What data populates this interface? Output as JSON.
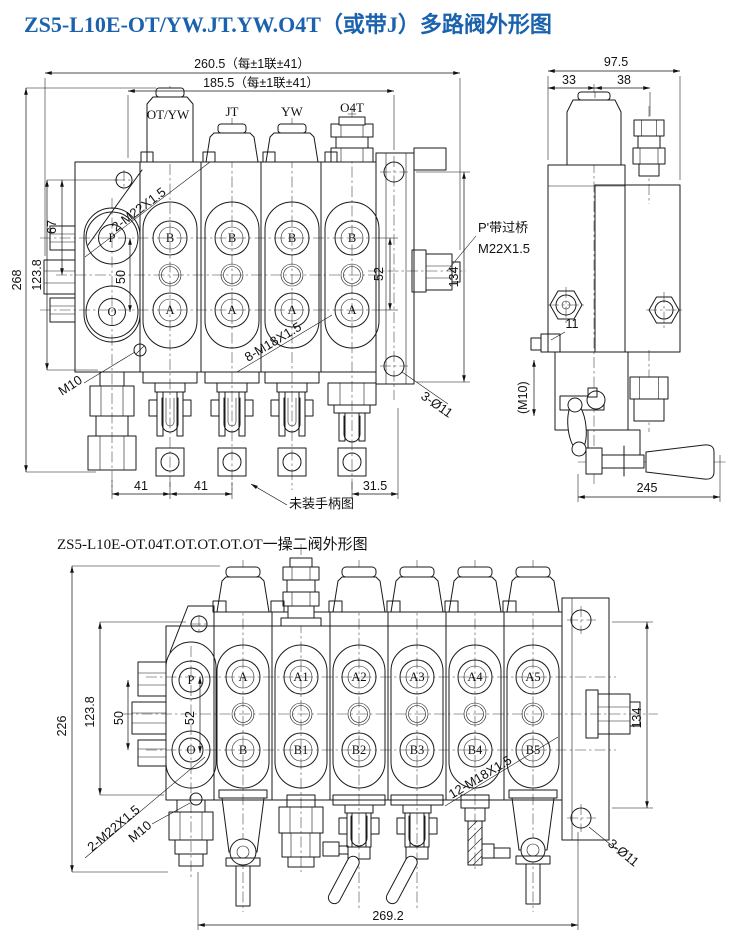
{
  "colors": {
    "background": "#ffffff",
    "line": "#1a1a1a",
    "title": "#1b62ae"
  },
  "fig1": {
    "title": "ZS5-L10E-OT/YW.JT.YW.O4T（或带J）多路阀外形图",
    "front": {
      "dim_total_width": "260.5（每±1联±41）",
      "dim_inner_width": "185.5（每±1联±41）",
      "dim_total_height": "268",
      "dim_mid_height": "123.8",
      "dim_top_height": "67",
      "dim_po_spacing": "50",
      "dim_ab_spacing": "52",
      "dim_plate_height": "134",
      "dim_spool_pitch_1": "41",
      "dim_spool_pitch_2": "41",
      "dim_end_offset": "31.5",
      "section_labels": [
        "OT/YW",
        "JT",
        "YW",
        "O4T"
      ],
      "port_p": "P",
      "port_o": "O",
      "port_b": "B",
      "port_a": "A",
      "ann_inlet_thread": "2-M22X1.5",
      "ann_drain_thread": "M10",
      "ann_work_thread": "8-M18X1.5",
      "ann_mount_holes": "3-Ø11",
      "ann_bridge_line1": "P'带过桥",
      "ann_bridge_line2": "M22X1.5",
      "ann_no_handle": "未装手柄图"
    },
    "side": {
      "dim_total_width": "97.5",
      "dim_left_width": "33",
      "dim_right_width": "38",
      "dim_port_offset": "11",
      "ann_drain_thread": "(M10)",
      "dim_handle_length": "245"
    }
  },
  "fig2": {
    "title": "ZS5-L10E-OT.04T.OT.OT.OT.OT一操二阀外形图",
    "dim_total_height": "226",
    "dim_mid_height": "123.8",
    "dim_po_spacing": "50",
    "dim_ab_spacing": "52",
    "dim_plate_height": "134",
    "dim_total_width": "269.2",
    "port_p": "P",
    "port_o": "O",
    "ports_a": [
      "A",
      "A1",
      "A2",
      "A3",
      "A4",
      "A5"
    ],
    "ports_b": [
      "B",
      "B1",
      "B2",
      "B3",
      "B4",
      "B5"
    ],
    "ann_inlet_thread": "2-M22X1.5",
    "ann_drain_thread": "M10",
    "ann_work_thread": "12-M18X1.5",
    "ann_mount_holes": "3-Ø11"
  }
}
